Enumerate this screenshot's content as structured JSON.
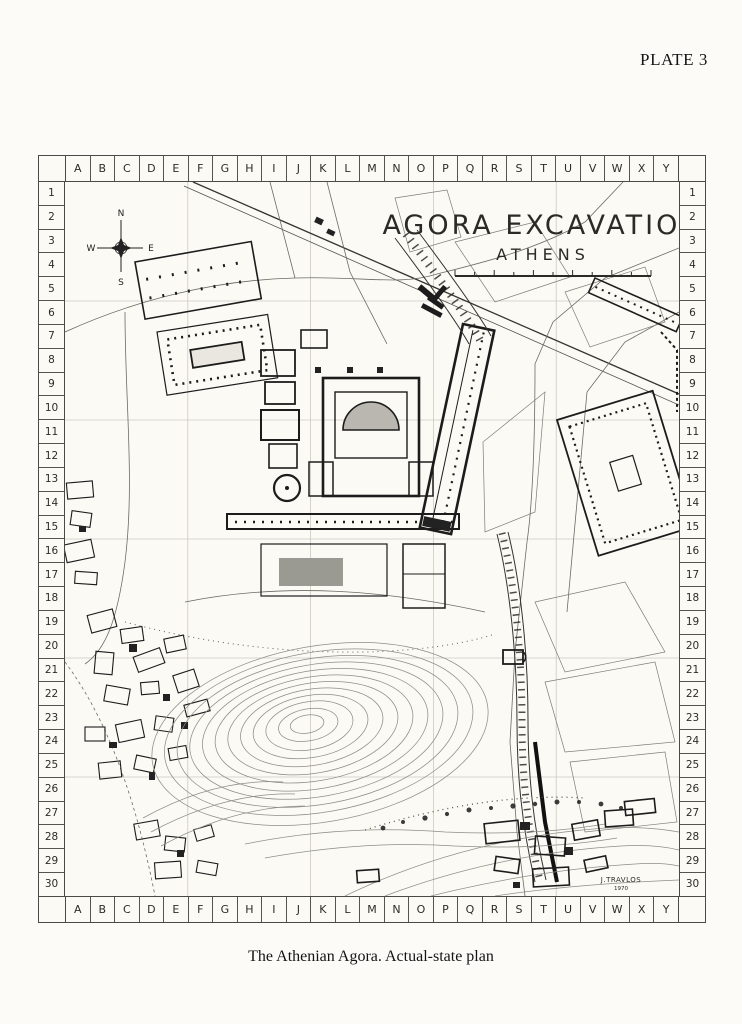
{
  "page": {
    "plate_label": "PLATE 3",
    "caption": "The Athenian Agora. Actual-state plan"
  },
  "map": {
    "title": "AGORA EXCAVATION",
    "subtitle": "ATHENS",
    "signature": "J.TRAVLOS",
    "signature_year": "1970",
    "compass": {
      "north": "N",
      "east": "E",
      "south": "S",
      "west": "W"
    },
    "grid": {
      "columns": [
        "A",
        "B",
        "C",
        "D",
        "E",
        "F",
        "G",
        "H",
        "I",
        "J",
        "K",
        "L",
        "M",
        "N",
        "O",
        "P",
        "Q",
        "R",
        "S",
        "T",
        "U",
        "V",
        "W",
        "X",
        "Y"
      ],
      "rows": [
        "1",
        "2",
        "3",
        "4",
        "5",
        "6",
        "7",
        "8",
        "9",
        "10",
        "11",
        "12",
        "13",
        "14",
        "15",
        "16",
        "17",
        "18",
        "19",
        "20",
        "21",
        "22",
        "23",
        "24",
        "25",
        "26",
        "27",
        "28",
        "29",
        "30"
      ]
    }
  }
}
